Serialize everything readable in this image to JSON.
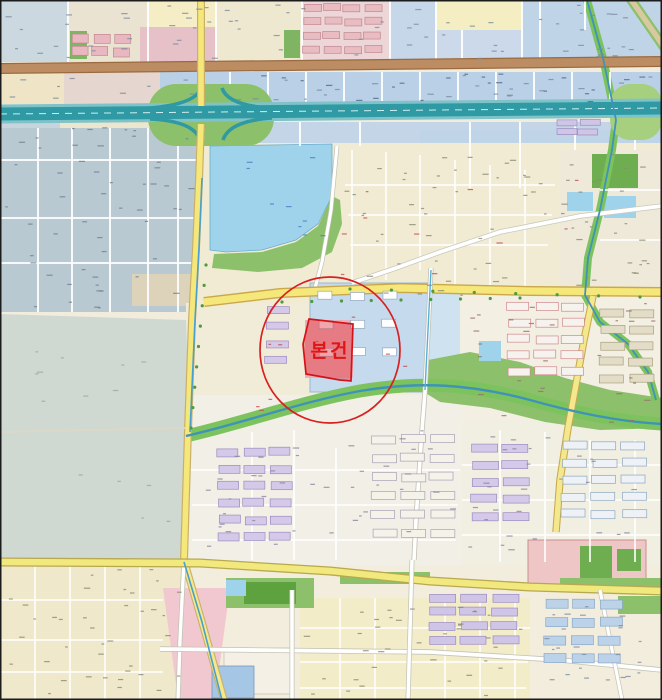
{
  "annotation": {
    "label": "본건",
    "label_color": "#e01515",
    "circle": {
      "cx": 330,
      "cy": 350,
      "rx": 70,
      "ry": 73,
      "stroke": "#d8201f",
      "width": 1.7
    },
    "parcel": {
      "points": "309,319 353,324 351,381 340,380 306,374 303,344",
      "fill": "rgba(224,60,70,0.46)",
      "stroke": "#d41318",
      "width": 1.7
    }
  },
  "palette": {
    "background": "#f1ecdc",
    "water": "#9fd3ec",
    "river_bank": "#7cc35e",
    "river_water": "#3f93b8",
    "park": "#8cc06a",
    "sport_field": "#5ea23f",
    "expressway": "#2f9aa3",
    "expressway_edge": "#7fc3c8",
    "road_brown": "#bc8d62",
    "road_yellow": "#f6e77a",
    "airfield": "#cfd9d2",
    "industrial": "#b9c9d2",
    "commercial_blue": "#b9d0e6",
    "residential_yellow": "#f2ebd3",
    "campus_blue": "#c5daed",
    "campus_pink": "#eec6c6",
    "apartment_lavender": "#d4c9e8",
    "apartment_pink": "#e9bcc2"
  }
}
